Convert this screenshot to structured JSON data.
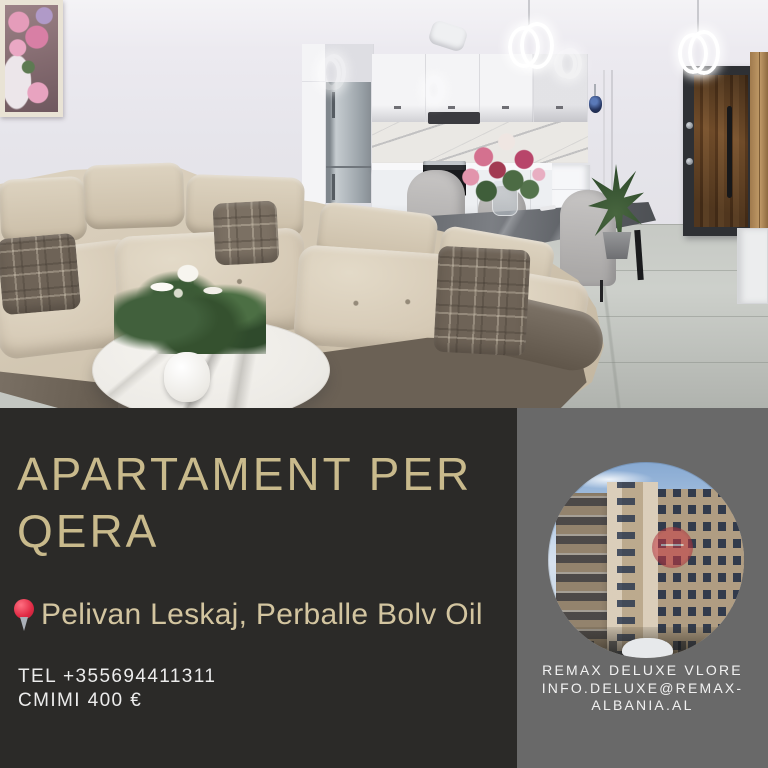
{
  "flyer": {
    "headline": "APARTAMENT PER QERA",
    "location": "Pelivan Leskaj, Perballe Bolv Oil",
    "contact": {
      "tel": "TEL +355694411311",
      "price": "CMIMI 400 €"
    },
    "agency": {
      "lines": [
        "REMAX DELUXE VLORE",
        "INFO.DELUXE@REMAX-",
        "ALBANIA.AL"
      ]
    },
    "icons": {
      "location_pin": "location-pin-icon"
    },
    "colors": {
      "left_panel_bg": "#2b2a28",
      "right_panel_bg": "#696969",
      "headline_text": "#c9ba8c",
      "location_text": "#d3c5a0",
      "contact_text": "#ececec",
      "agency_text": "#f2f2f2",
      "pin_red": "#e02a44"
    },
    "photos": {
      "main": "apartment living room with beige corner sofa and white kitchen",
      "circle": "low-angle exterior of beige apartment building"
    }
  }
}
